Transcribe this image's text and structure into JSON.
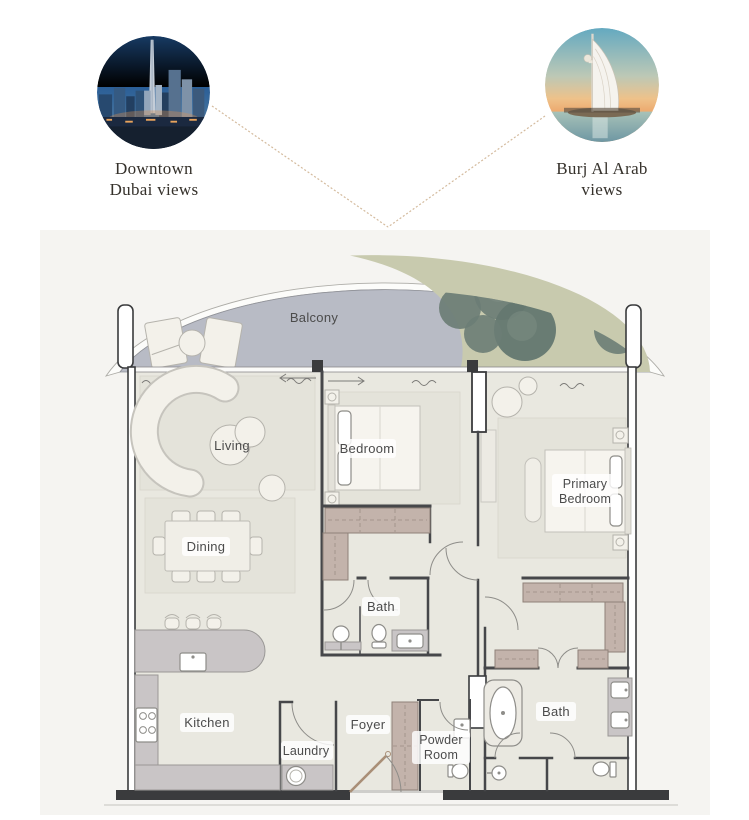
{
  "views": {
    "left": {
      "caption_line1": "Downtown",
      "caption_line2": "Dubai views",
      "image": "downtown-dubai-skyline-photo"
    },
    "right": {
      "caption_line1": "Burj Al Arab",
      "caption_line2": "views",
      "image": "burj-al-arab-photo"
    }
  },
  "floorplan": {
    "labels": {
      "balcony": "Balcony",
      "living": "Living",
      "dining": "Dining",
      "bedroom": "Bedroom",
      "primary_bedroom_line1": "Primary",
      "primary_bedroom_line2": "Bedroom",
      "bath": "Bath",
      "primary_bath": "Bath",
      "kitchen": "Kitchen",
      "laundry": "Laundry",
      "foyer": "Foyer",
      "powder_room_line1": "Powder",
      "powder_room_line2": "Room"
    },
    "colors": {
      "plan_background": "#f5f4f1",
      "floor": "#e9e8e0",
      "balcony_paving": "#b8bbc5",
      "planting": "#c8caae",
      "tree": "#6b7d75",
      "wall": "#3a3b3d",
      "wardrobe": "#c3b3ab",
      "counter": "#c9c5c6",
      "connector_line": "#d4bb9e",
      "label_text": "#4b4b4b"
    }
  }
}
